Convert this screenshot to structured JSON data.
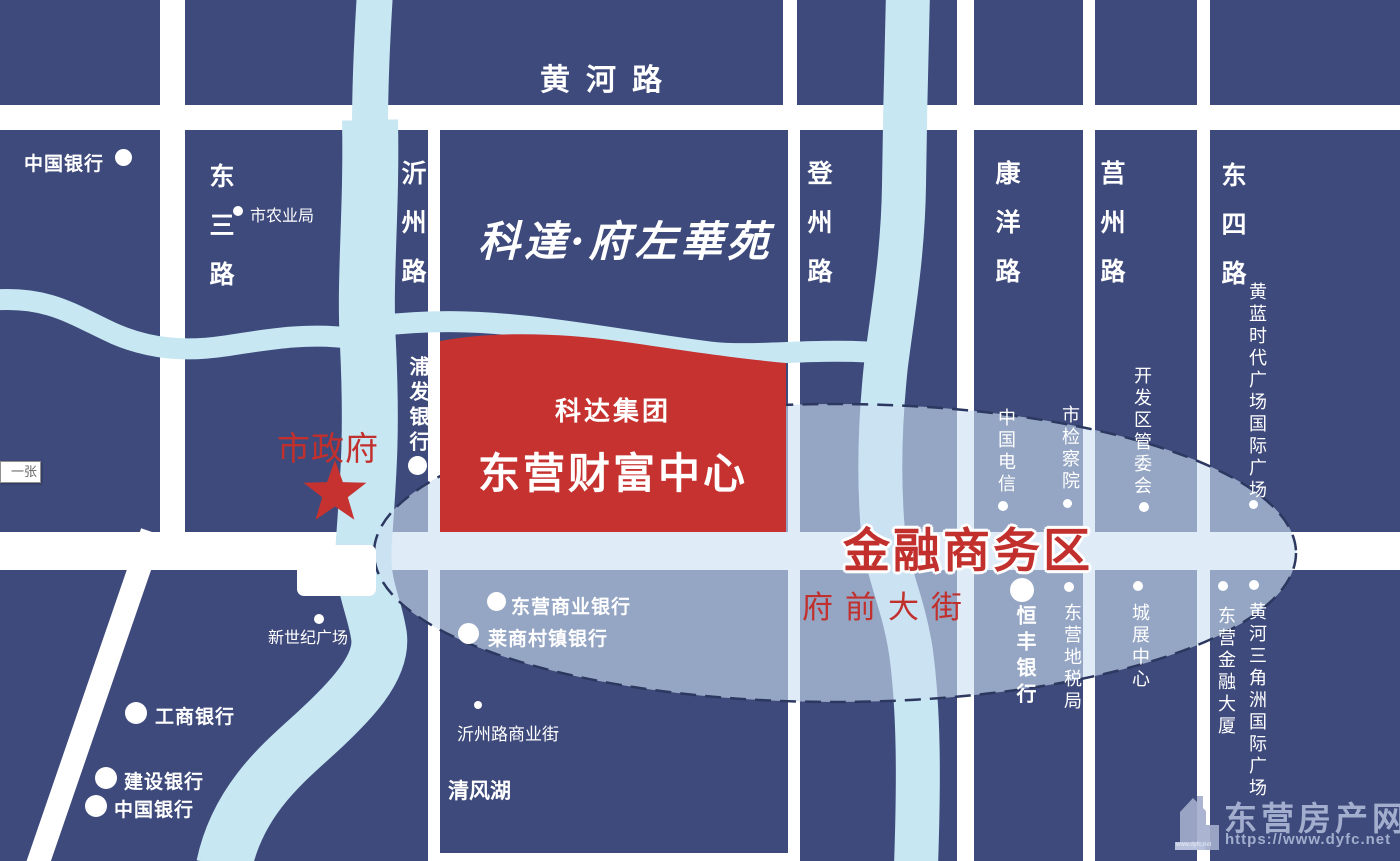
{
  "colors": {
    "navy": "#3E4A7B",
    "river": "#C7E7F3",
    "parcel_red": "#C63230",
    "text_red": "#C2302D",
    "ellipse_fill": "rgba(203,222,240,0.62)",
    "ellipse_border": "#2C3860",
    "watermark": "#A3AECE"
  },
  "calligraphy_title": "科達·府左華苑",
  "project": {
    "group": "科达集团",
    "name": "东营财富中心"
  },
  "zone": {
    "label": "金融商务区",
    "street": "府前大街"
  },
  "city_gov": {
    "label": "市政府"
  },
  "tooltip": {
    "label": "一张"
  },
  "roads": {
    "huanghe": "黄河路",
    "dongsan": "东三路",
    "yizhou": "沂州路",
    "dengzhou": "登州路",
    "kangyang": "康洋路",
    "juzhou": "莒州路",
    "dongsi": "东四路"
  },
  "pois": {
    "boc_top": "中国银行",
    "agri": "市农业局",
    "pufa": "浦发银行",
    "xinshiji": "新世纪广场",
    "gongshang": "工商银行",
    "jianshe": "建设银行",
    "boc_bottom": "中国银行",
    "dysy_bank": "东营商业银行",
    "laishang": "莱商村镇银行",
    "yizhou_biz": "沂州路商业街",
    "qingfeng": "清风湖",
    "telecom": "中国电信",
    "procuratorate": "市检察院",
    "kaifaqu": "开发区管委会",
    "huanglan": "黄蓝时代广场国际广场",
    "hengfeng": "恒丰银行",
    "dishui": "东营地税局",
    "chengzhan": "城展中心",
    "delta_plaza": "黄河三角洲国际广场",
    "jinrong_tower": "东营金融大厦"
  },
  "watermark": {
    "name": "东营房产网",
    "url": "https://www.dyfc.net",
    "icon_caption": "www.dyfc.net"
  }
}
